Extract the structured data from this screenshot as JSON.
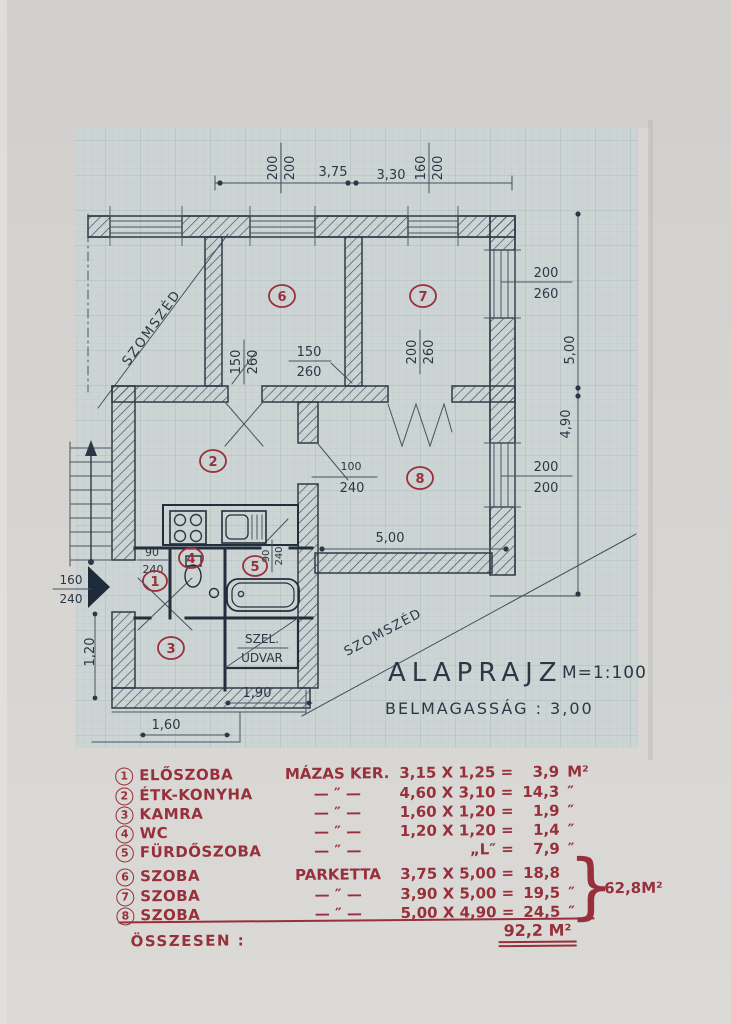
{
  "title": {
    "main": "ALAPRAJZ",
    "scale": "M=1:100",
    "height_note": "BELMAGASSÁG : 3,00"
  },
  "plan": {
    "rooms": [
      "1",
      "2",
      "3",
      "4",
      "5",
      "6",
      "7",
      "8"
    ],
    "labels": {
      "neighbor": "SZOMSZÉD",
      "shaft_line1": "SZEL.",
      "shaft_line2": "UDVAR"
    },
    "dims": {
      "top_window_left": {
        "num": "200",
        "den": "200"
      },
      "top_len_a": "3,75",
      "top_len_b": "3,30",
      "top_window_right": {
        "num": "160",
        "den": "200"
      },
      "right_window_7": {
        "num": "200",
        "den": "260"
      },
      "right_h_a": "5,00",
      "right_h_b": "4,90",
      "right_window_8": {
        "num": "200",
        "den": "200"
      },
      "door_6_left": {
        "num": "150",
        "den": "260"
      },
      "door_6_right": {
        "num": "150",
        "den": "260"
      },
      "door_7": {
        "num": "200",
        "den": "260"
      },
      "door_8": {
        "num": "100",
        "den": "240"
      },
      "room8_width": "5,00",
      "door_wc": {
        "num": "90",
        "den": "240"
      },
      "door_bath": {
        "num": "90",
        "den": "240"
      },
      "entrance_door": {
        "num": "160",
        "den": "240"
      },
      "left_height": "1,20",
      "bottom_a": "1,90",
      "bottom_b": "1,60"
    }
  },
  "legend": {
    "rows": [
      {
        "num": "1",
        "name": "ELŐSZOBA",
        "floor": "MÁZAS KER.",
        "calc": "3,15 X 1,25 =",
        "area": "3,9",
        "unit": "M²"
      },
      {
        "num": "2",
        "name": "ÉTK-KONYHA",
        "floor": "— ″ —",
        "calc": "4,60 X 3,10 =",
        "area": "14,3",
        "unit": "″"
      },
      {
        "num": "3",
        "name": "KAMRA",
        "floor": "— ″ —",
        "calc": "1,60 X 1,20 =",
        "area": "1,9",
        "unit": "″"
      },
      {
        "num": "4",
        "name": "WC",
        "floor": "— ″ —",
        "calc": "1,20 X 1,20 =",
        "area": "1,4",
        "unit": "″"
      },
      {
        "num": "5",
        "name": "FÜRDŐSZOBA",
        "floor": "— ″ —",
        "calc": "„L″ =",
        "area": "7,9",
        "unit": "″"
      },
      {
        "num": "6",
        "name": "SZOBA",
        "floor": "PARKETTA",
        "calc": "3,75 X 5,00 =",
        "area": "18,8",
        "unit": ""
      },
      {
        "num": "7",
        "name": "SZOBA",
        "floor": "— ″ —",
        "calc": "3,90 X 5,00 =",
        "area": "19,5",
        "unit": "″"
      },
      {
        "num": "8",
        "name": "SZOBA",
        "floor": "— ″ —",
        "calc": "5,00 X 4,90 =",
        "area": "24,5",
        "unit": "″"
      }
    ],
    "brace": "}",
    "group_total": "62,8M²",
    "total_label": "ÖSSZESEN :",
    "total_value": "92,2 M²"
  }
}
